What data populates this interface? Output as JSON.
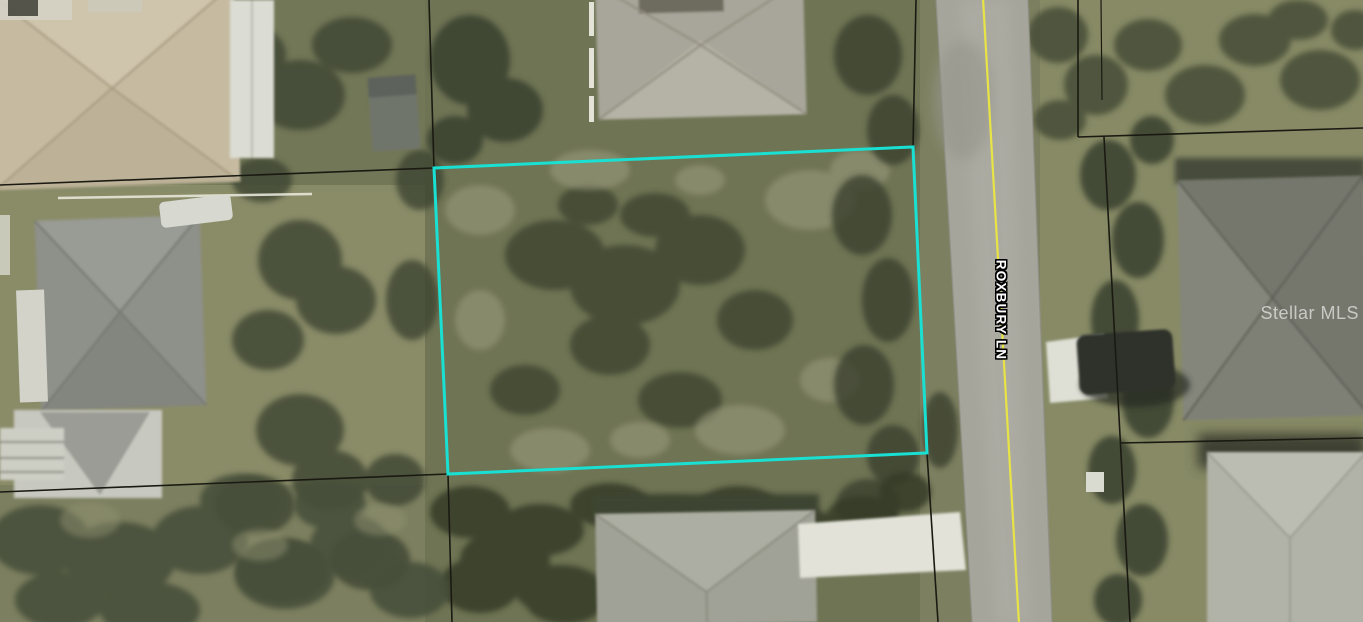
{
  "road": {
    "label": "ROXBURY LN"
  },
  "watermark": {
    "text": "Stellar MLS"
  },
  "colors": {
    "lot_outline_cyan": "#19E0D2",
    "road_centerline_yellow": "#E8E446",
    "parcel_line": "#1A1A12",
    "road_label_fill": "#FFFFFF",
    "road_label_outline": "#000000",
    "watermark_text": "rgba(255,255,255,0.6)"
  }
}
